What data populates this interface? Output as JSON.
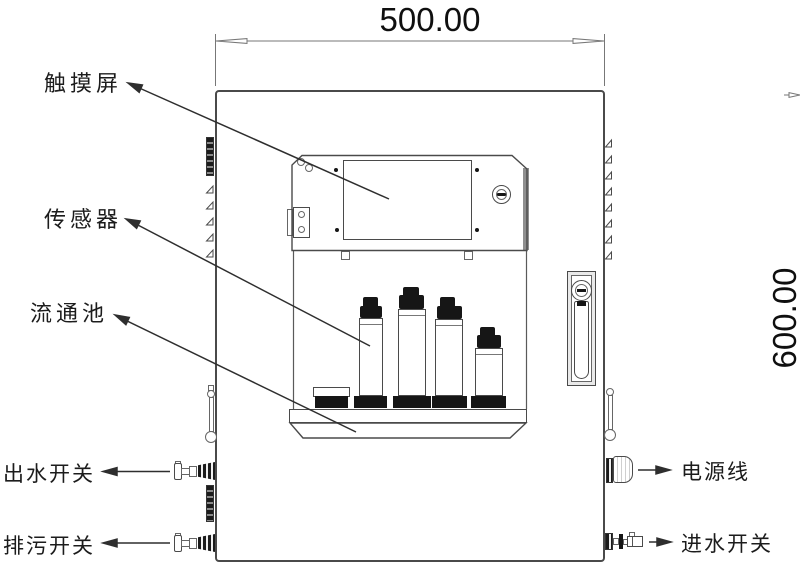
{
  "drawing": {
    "type": "technical front-view drawing of wall-mounted water quality analyzer cabinet",
    "dimensions": {
      "width_label": "500.00",
      "height_label": "600.00"
    },
    "labels": {
      "touchscreen": "触摸屏",
      "sensor": "传感器",
      "flow_cell": "流通池",
      "outlet_switch": "出水开关",
      "drain_switch": "排污开关",
      "power_cable": "电源线",
      "inlet_switch": "进水开关"
    },
    "colors": {
      "line": "#4a4a4a",
      "dark_fill": "#161616",
      "background": "#ffffff"
    }
  }
}
